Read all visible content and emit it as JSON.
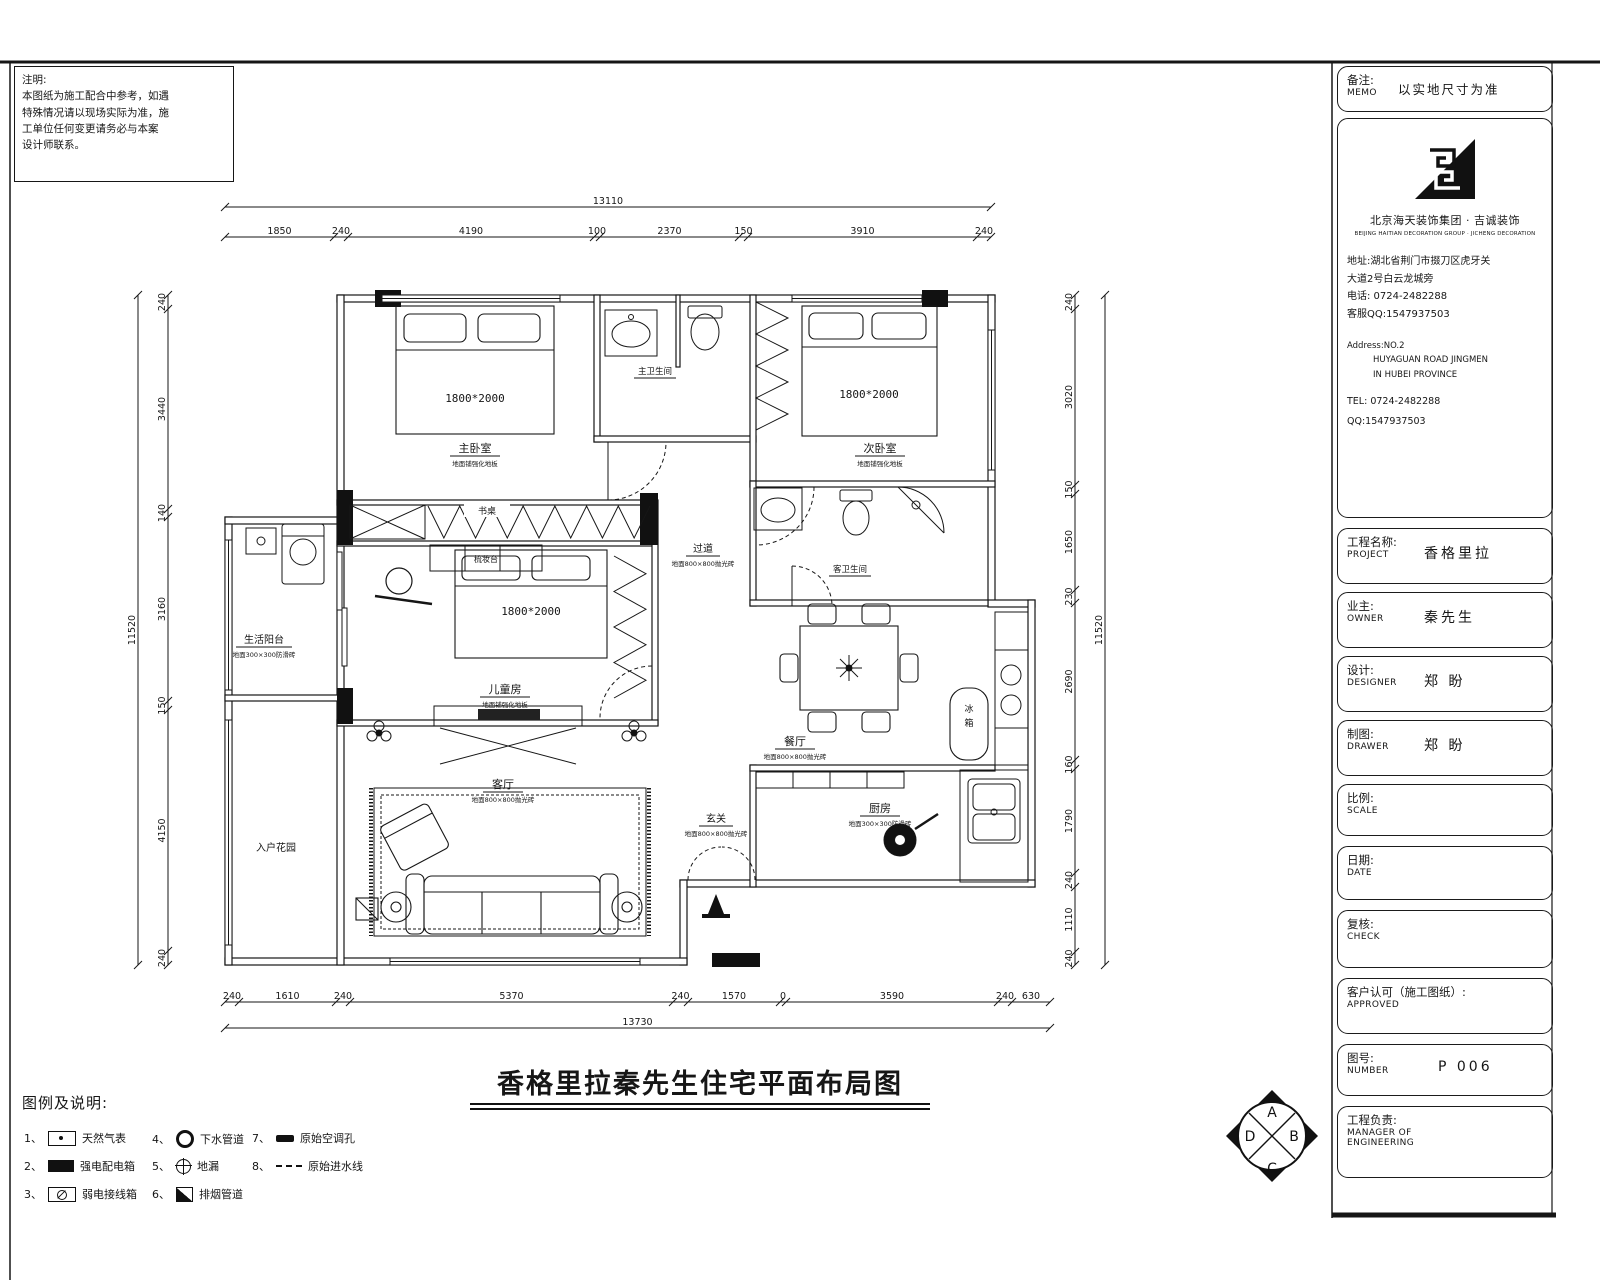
{
  "note": {
    "title": "注明:",
    "lines": [
      "本图纸为施工配合中参考，如遇",
      "特殊情况请以现场实际为准，施",
      "工单位任何变更请务必与本案",
      "设计师联系。"
    ]
  },
  "title_block": {
    "memo": {
      "cn": "备注:",
      "en": "MEMO",
      "value": "以实地尺寸为准"
    },
    "company": {
      "name": "北京海天装饰集团 · 吉诚装饰",
      "name_en": "BEIJING HAITIAN DECORATION GROUP · JICHENG DECORATION",
      "addr1": "地址:湖北省荆门市掇刀区虎牙关",
      "addr2": "大道2号白云龙城旁",
      "phone": "电话: 0724-2482288",
      "qq": "客服QQ:1547937503",
      "addr_en1": "Address:NO.2",
      "addr_en2": "HUYAGUAN ROAD JINGMEN",
      "addr_en3": "IN HUBEI PROVINCE",
      "tel_en": "TEL: 0724-2482288",
      "qq_en": "QQ:1547937503"
    },
    "project": {
      "cn": "工程名称:",
      "en": "PROJECT",
      "value": "香格里拉"
    },
    "owner": {
      "cn": "业主:",
      "en": "OWNER",
      "value": "秦先生"
    },
    "designer": {
      "cn": "设计:",
      "en": "DESIGNER",
      "value": "郑 盼"
    },
    "drawer": {
      "cn": "制图:",
      "en": "DRAWER",
      "value": "郑 盼"
    },
    "scale": {
      "cn": "比例:",
      "en": "SCALE",
      "value": ""
    },
    "date": {
      "cn": "日期:",
      "en": "DATE",
      "value": ""
    },
    "check": {
      "cn": "复核:",
      "en": "CHECK",
      "value": ""
    },
    "approved": {
      "cn": "客户认可（施工图纸）:",
      "en": "APPROVED",
      "value": ""
    },
    "number": {
      "cn": "图号:",
      "en": "NUMBER",
      "value": "P 006"
    },
    "manager": {
      "cn": "工程负责:",
      "en1": "MANAGER OF",
      "en2": "ENGINEERING"
    }
  },
  "main_title": "香格里拉秦先生住宅平面布局图",
  "legend": {
    "heading": "图例及说明:",
    "items": [
      {
        "no": "1、",
        "label": "天然气表"
      },
      {
        "no": "2、",
        "label": "强电配电箱"
      },
      {
        "no": "3、",
        "label": "弱电接线箱"
      },
      {
        "no": "4、",
        "label": "下水管道"
      },
      {
        "no": "5、",
        "label": "地漏"
      },
      {
        "no": "6、",
        "label": "排烟管道"
      },
      {
        "no": "7、",
        "label": "原始空调孔"
      },
      {
        "no": "8、",
        "label": "原始进水线"
      }
    ]
  },
  "compass": {
    "a": "A",
    "b": "B",
    "c": "C",
    "d": "D"
  },
  "dims": {
    "top": {
      "total": "13110",
      "segs": [
        "1850",
        "240",
        "4190",
        "100",
        "2370",
        "150",
        "3910",
        "240"
      ]
    },
    "bottom": {
      "total": "13730",
      "segs": [
        "240",
        "1610",
        "240",
        "5370",
        "240",
        "1570",
        "0",
        "3590",
        "240",
        "630"
      ]
    },
    "left": {
      "total": "11520",
      "segs": [
        "240",
        "3440",
        "140",
        "3160",
        "150",
        "4150",
        "240"
      ]
    },
    "right": {
      "total": "11520",
      "segs": [
        "240",
        "3020",
        "150",
        "1650",
        "230",
        "2690",
        "160",
        "1790",
        "240",
        "1110",
        "240"
      ]
    }
  },
  "rooms": {
    "master": {
      "name": "主卧室",
      "note": "地面铺强化地板",
      "bed": "1800*2000"
    },
    "second": {
      "name": "次卧室",
      "note": "地面铺强化地板",
      "bed": "1800*2000"
    },
    "kids": {
      "name": "儿童房",
      "note": "地面铺强化地板",
      "bed": "1800*2000"
    },
    "living": {
      "name": "客厅",
      "note": "地面800×800抛光砖"
    },
    "dining": {
      "name": "餐厅",
      "note": "地面800×800抛光砖"
    },
    "kitchen": {
      "name": "厨房",
      "note": "地面300×300防滑砖"
    },
    "hall": {
      "name": "过道",
      "note": "地面800×800抛光砖"
    },
    "entry": {
      "name": "玄关",
      "note": "地面800×800抛光砖"
    },
    "balcony": {
      "name": "生活阳台",
      "note": "地面300×300防滑砖"
    },
    "garden": {
      "name": "入户花园"
    },
    "bath_master": {
      "name": "主卫生间"
    },
    "bath_guest": {
      "name": "客卫生间"
    },
    "desk": "书桌",
    "dresser": "梳妆台",
    "fridge1": "冰",
    "fridge2": "箱"
  }
}
